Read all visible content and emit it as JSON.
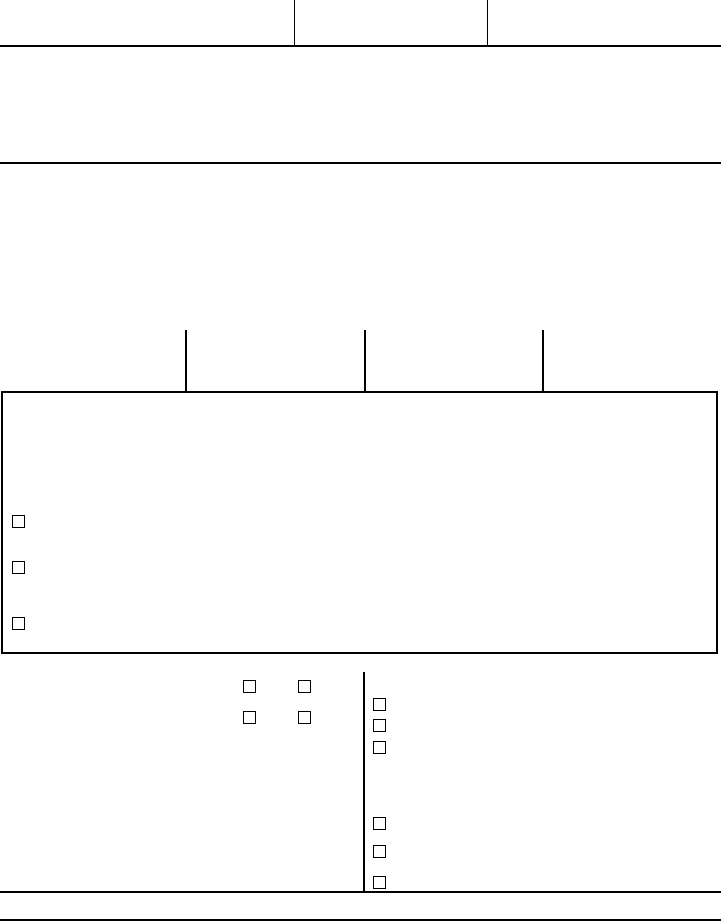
{
  "page": {
    "background_color": "#ffffff",
    "line_color": "#000000",
    "visible_text": ""
  },
  "header_row": {
    "column_count": 3
  },
  "upper_section": {
    "column_tick_count": 3
  },
  "checkboxes": {
    "boxed_section": [
      {
        "checked": false
      },
      {
        "checked": false
      },
      {
        "checked": false
      }
    ],
    "left_grid": [
      {
        "checked": false
      },
      {
        "checked": false
      },
      {
        "checked": false
      },
      {
        "checked": false
      }
    ],
    "right_column_upper": [
      {
        "checked": false
      },
      {
        "checked": false
      },
      {
        "checked": false
      }
    ],
    "right_column_lower": [
      {
        "checked": false
      },
      {
        "checked": false
      },
      {
        "checked": false
      }
    ]
  }
}
